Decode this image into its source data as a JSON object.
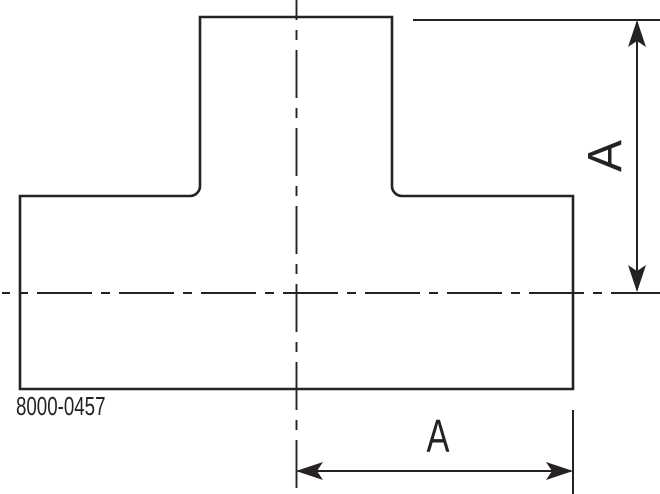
{
  "drawing": {
    "type": "technical-drawing-tee-fitting",
    "part_number": "8000-0457",
    "dimensions": {
      "right_vertical": {
        "label": "A"
      },
      "bottom_horizontal": {
        "label": "A"
      }
    },
    "line_color": "#262223",
    "background_color": "#ffffff"
  }
}
